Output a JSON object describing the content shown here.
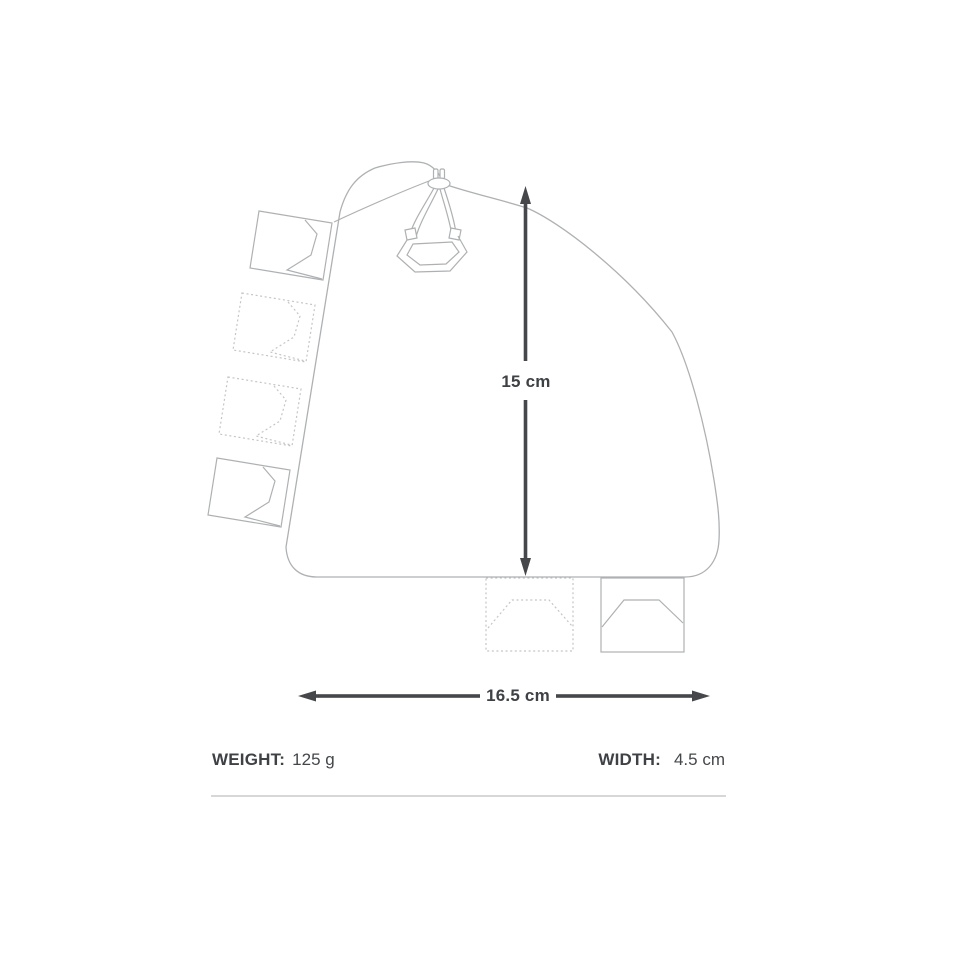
{
  "page": {
    "background_color": "#ffffff",
    "subject": "top tube frame bag technical line drawing, side view"
  },
  "diagram": {
    "line_color": "#aeb1b3",
    "dimension_color": "#45474a",
    "height_dimension": {
      "label": "15 cm"
    },
    "width_dimension": {
      "label": "16.5 cm"
    },
    "icons": {
      "zipper_pull": "hexagon-cord-pull-icon",
      "side_straps": "hook-and-loop-strap-tab (2 solid, 2 dotted alternate positions)",
      "bottom_straps": "bottom-mount-strap-tab (1 dotted alternate, 1 solid)"
    }
  },
  "specs": {
    "weight_label": "WEIGHT:",
    "weight_value": "125 g",
    "width_label": "WIDTH:",
    "width_value": "4.5 cm"
  },
  "colors": {
    "accent_text": "#3e4145",
    "divider": "#d7d7d7"
  }
}
